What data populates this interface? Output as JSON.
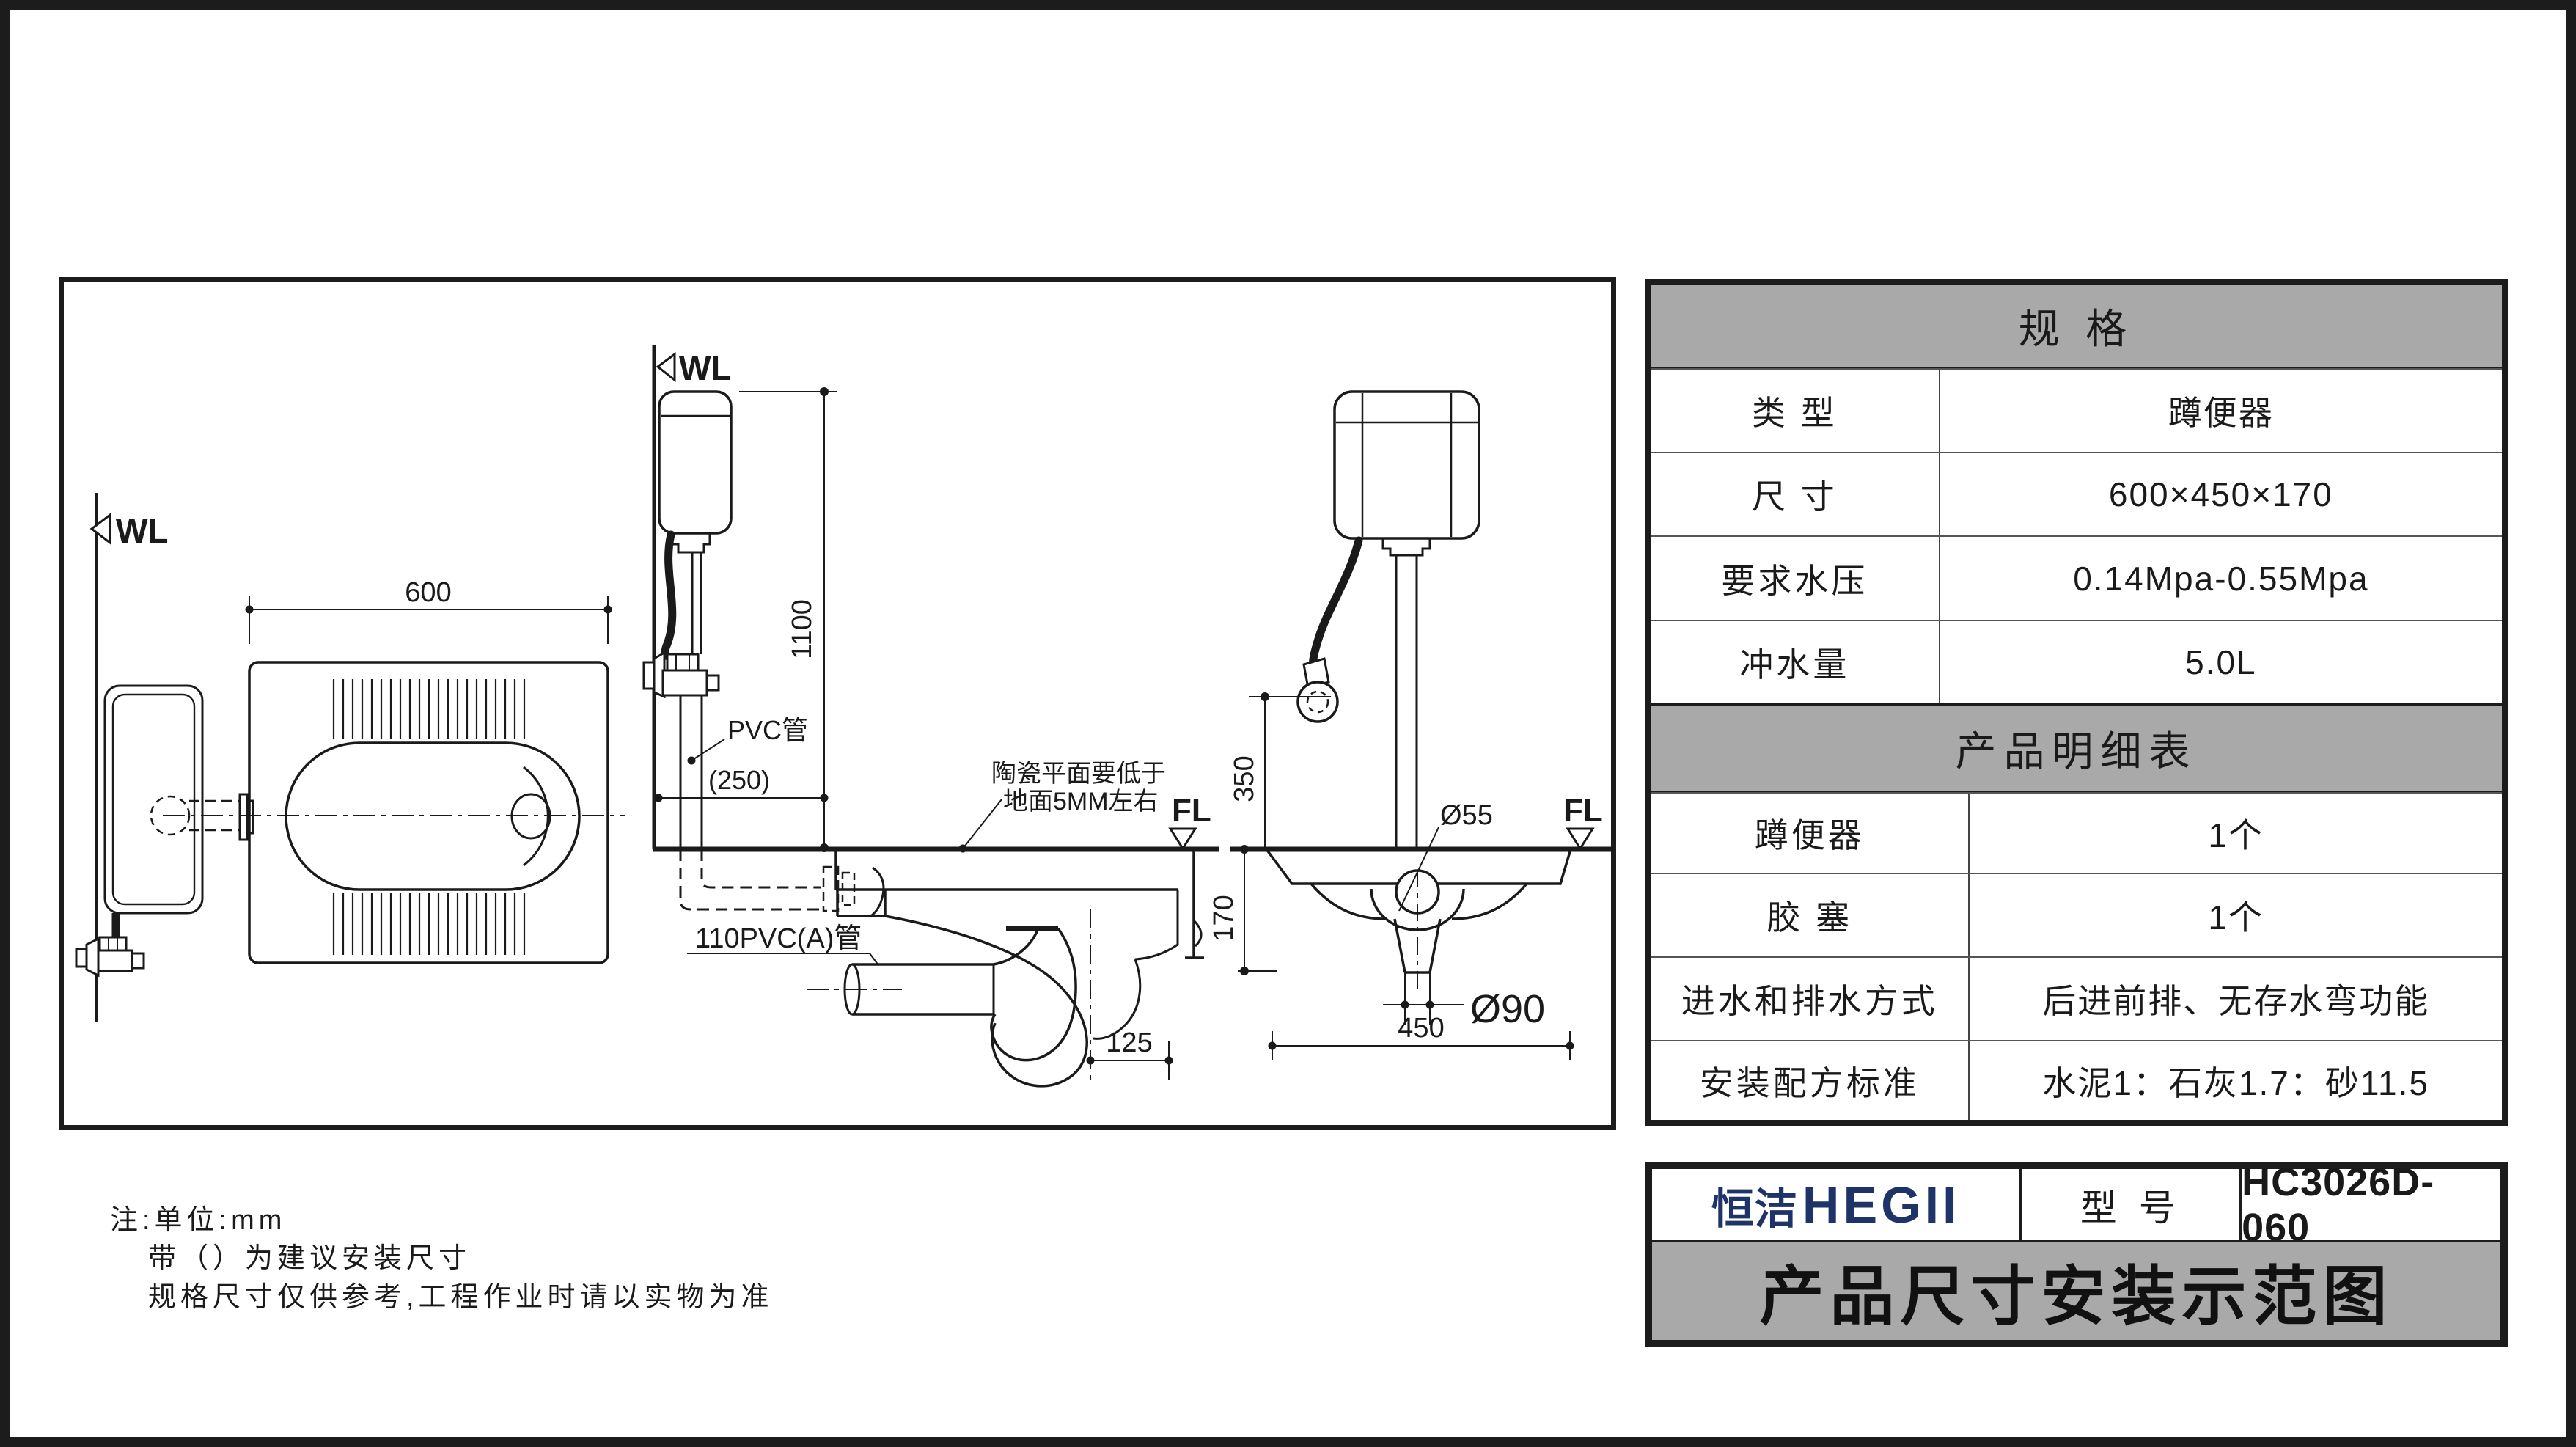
{
  "drawing": {
    "wl": "WL",
    "fl": "FL",
    "plan": {
      "dim_width": "600"
    },
    "section": {
      "dim_height": "1100",
      "pvc_label": "PVC管",
      "dim_inlet_offset": "(250)",
      "note_line1": "陶瓷平面要低于",
      "note_line2": "地面5MM左右",
      "drain_label": "110PVC(A)管",
      "dim_trap_offset": "125"
    },
    "front": {
      "dim_inlet_height": "350",
      "dia_drain": "Ø55",
      "dim_pan_depth": "170",
      "dia_outlet": "Ø90",
      "dim_pan_width": "450"
    }
  },
  "notes": {
    "line1": "注:单位:mm",
    "line2": "带（）为建议安装尺寸",
    "line3": "规格尺寸仅供参考,工程作业时请以实物为准"
  },
  "spec_table": {
    "title": "规  格",
    "rows": [
      {
        "label": "类  型",
        "value": "蹲便器"
      },
      {
        "label": "尺  寸",
        "value": "600×450×170"
      },
      {
        "label": "要求水压",
        "value": "0.14Mpa-0.55Mpa"
      },
      {
        "label": "冲水量",
        "value": "5.0L"
      }
    ]
  },
  "detail_table": {
    "title": "产品明细表",
    "rows": [
      {
        "label": "蹲便器",
        "value": "1个"
      },
      {
        "label": "胶  塞",
        "value": "1个"
      },
      {
        "label": "进水和排水方式",
        "value": "后进前排、无存水弯功能"
      },
      {
        "label": "安装配方标准",
        "value": "水泥1：石灰1.7：砂11.5"
      }
    ]
  },
  "title_block": {
    "brand_cn": "恒洁",
    "brand_en": "HEGII",
    "model_label": "型 号",
    "model_value": "HC3026D-060",
    "sheet_title": "产品尺寸安装示范图"
  },
  "colors": {
    "accent_navy": "#1e3468",
    "header_gray": "#a9a9a9",
    "line_black": "#1a1a1a"
  }
}
